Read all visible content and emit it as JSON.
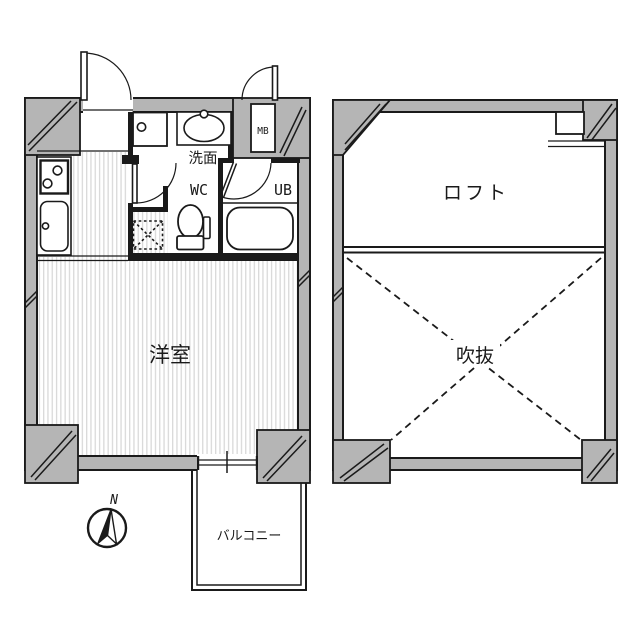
{
  "plans": {
    "unit": {
      "labels": {
        "room": "洋室",
        "washbasin": "洗面",
        "wc": "WC",
        "unit_bath": "UB",
        "meter_box": "MB",
        "balcony": "バルコニー"
      }
    },
    "loft": {
      "labels": {
        "loft": "ロフト",
        "void": "吹抜"
      }
    }
  },
  "compass": {
    "north": "N"
  },
  "colors": {
    "wall": "#b5b5b5",
    "line": "#1a1a1a",
    "stripe": "#d9d9d9",
    "bg": "#ffffff"
  }
}
